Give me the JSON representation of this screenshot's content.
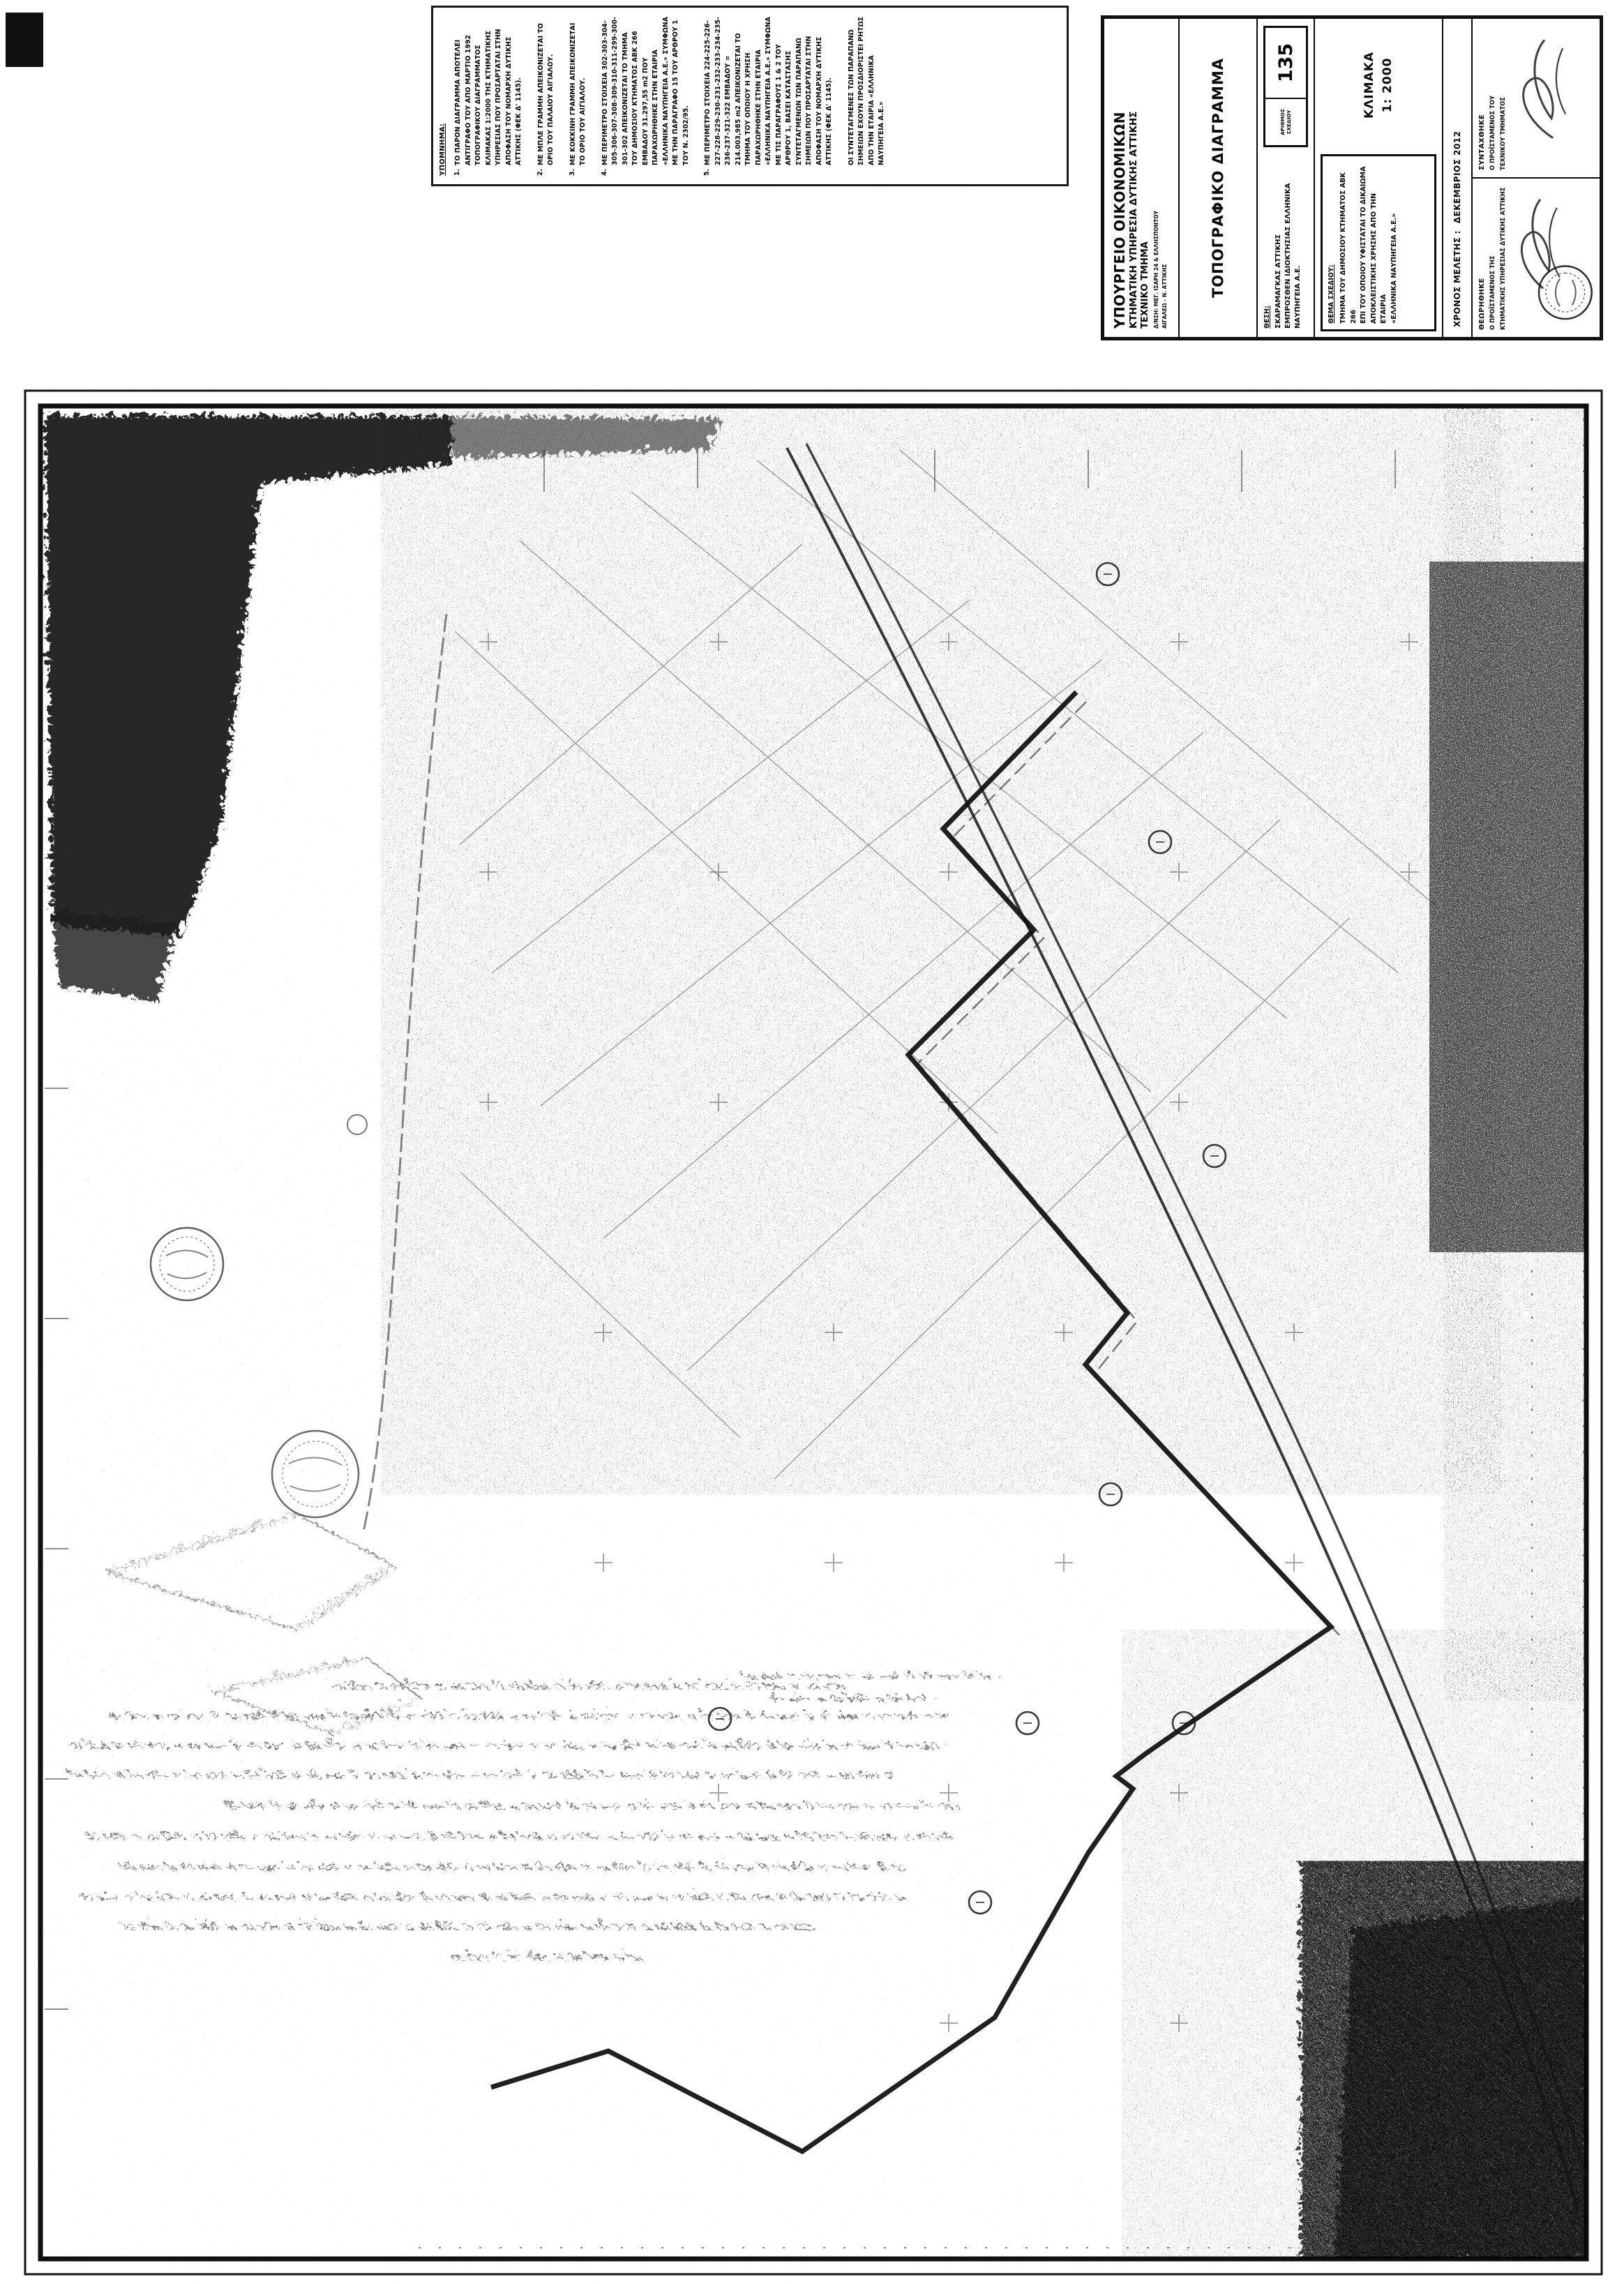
{
  "title_block": {
    "ministry": "ΥΠΟΥΡΓΕΙΟ ΟΙΚΟΝΟΜΙΚΩΝ",
    "service": "ΚΤΗΜΑΤΙΚΗ ΥΠΗΡΕΣΙΑ ΔΥΤΙΚΗΣ ΑΤΤΙΚΗΣ",
    "department": "ΤΕΧΝΙΚΟ ΤΜΗΜΑ",
    "address_line1": "Δ/ΝΣΗ: ΜΕΓ. ΙΣΑΡΗ 24 & ΕΛΛΗΣΠΟΝΤΟΥ",
    "address_line2": "ΑΙΓΑΛΕΩ - Ν. ΑΤΤΙΚΗΣ",
    "drawing_type": "ΤΟΠΟΓΡΑΦΙΚΟ ΔΙΑΓΡΑΜΜΑ",
    "location_label": "ΘΕΣΗ:",
    "location_line1": "ΣΚΑΡΑΜΑΓΚΑΣ ΑΤΤΙΚΗΣ",
    "location_line2": "ΕΜΠΡΟΣΘΕΝ ΙΔΙΟΚΤΗΣΙΑΣ ΕΛΛΗΝΙΚΑ ΝΑΥΠΗΓΕΙΑ Α.Ε.",
    "sheet_number_label": "ΑΡΙΘΜΟΣ ΣΧΕΔΙΟΥ",
    "sheet_number": "135",
    "scale_label": "ΚΛΙΜΑΚΑ",
    "scale_value": "1: 2000",
    "subject_label": "ΘΕΜΑ ΣΧΕΔΙΟΥ:",
    "subject_lines": {
      "0": "ΤΜΗΜΑ ΤΟΥ ΔΗΜΟΣΙΟΥ ΚΤΗΜΑΤΟΣ ΑΒΚ 266",
      "1": "ΕΠΙ ΤΟΥ ΟΠΟΙΟΥ ΥΦΙΣΤΑΤΑΙ ΤΟ ΔΙΚΑΙΩΜΑ",
      "2": "ΑΠΟΚΛΕΙΣΤΙΚΗΣ ΧΡΗΣΗΣ ΑΠΟ ΤΗΝ ΕΤΑΙΡΙΑ",
      "3": "«ΕΛΛΗΝΙΚΑ ΝΑΥΠΗΓΕΙΑ Α.Ε.»"
    },
    "date_label": "ΧΡΟΝΟΣ ΜΕΛΕΤΗΣ :",
    "date_value": "ΔΕΚΕΜΒΡΙΟΣ 2012",
    "reviewed_label": "ΘΕΩΡΗΘΗΚΕ",
    "reviewed_title_line1": "Ο ΠΡΟΪΣΤΑΜΕΝΟΣ ΤΗΣ",
    "reviewed_title_line2": "ΚΤΗΜΑΤΙΚΗΣ ΥΠΗΡΕΣΙΑΣ ΔΥΤΙΚΗΣ ΑΤΤΙΚΗΣ",
    "drafted_label": "ΣΥΝΤΑΧΘΗΚΕ",
    "drafted_title_line1": "Ο ΠΡΟΪΣΤΑΜΕΝΟΣ ΤΟΥ",
    "drafted_title_line2": "ΤΕΧΝΙΚΟΥ ΤΜΗΜΑΤΟΣ"
  },
  "notes_block": {
    "heading": "ΥΠΟΜΝΗΜΑ:",
    "notes": {
      "0": {
        "num": "1.",
        "text": "ΤΟ ΠΑΡΟΝ ΔΙΑΓΡΑΜΜΑ ΑΠΟΤΕΛΕΙ ΑΝΤΙΓΡΑΦΟ ΤΟΥ ΑΠΟ ΜΑΡΤΙΟ 1992 ΤΟΠΟΓΡΑΦΙΚΟΥ ΔΙΑΓΡΑΜΜΑΤΟΣ ΚΛΙΜΑΚΑΣ 1:2000 ΤΗΣ ΚΤΗΜΑΤΙΚΗΣ ΥΠΗΡΕΣΙΑΣ ΠΟΥ ΠΡΟΣΑΡΤΑΤΑΙ ΣΤΗΝ ΑΠΟΦΑΣΗ ΤΟΥ ΝΟΜΑΡΧΗ ΔΥΤΙΚΗΣ ΑΤΤΙΚΗΣ (ΦΕΚ Δ' 1145)."
      },
      "1": {
        "num": "2.",
        "text": "ΜΕ ΜΠΛΕ ΓΡΑΜΜΗ ΑΠΕΙΚΟΝΙΖΕΤΑΙ ΤΟ ΟΡΙΟ ΤΟΥ ΠΑΛΑΙΟΥ ΑΙΓΙΑΛΟΥ."
      },
      "2": {
        "num": "3.",
        "text": "ΜΕ ΚΟΚΚΙΝΗ ΓΡΑΜΜΗ ΑΠΕΙΚΟΝΙΖΕΤΑΙ ΤΟ ΟΡΙΟ ΤΟΥ ΑΙΓΙΑΛΟΥ."
      },
      "3": {
        "num": "4.",
        "text": "ΜΕ ΠΕΡΙΜΕΤΡΟ ΣΤΟΙΧΕΙΑ 302-303-304-305-306-307-308-309-310-311-299-300-301-302 ΑΠΕΙΚΟΝΙΖΕΤΑΙ ΤΟ ΤΜΗΜΑ ΤΟΥ ΔΗΜΟΣΙΟΥ ΚΤΗΜΑΤΟΣ ΑΒΚ 266 ΕΜΒΑΔΟΥ 31.297,55 m2 ΠΟΥ ΠΑΡΑΧΩΡΗΘΗΚΕ ΣΤΗΝ ΕΤΑΙΡΙΑ «ΕΛΛΗΝΙΚΑ ΝΑΥΠΗΓΕΙΑ Α.Ε.» ΣΥΜΦΩΝΑ ΜΕ ΤΗΝ ΠΑΡΑΓΡΑΦΟ 15 ΤΟΥ ΑΡΘΡΟΥ 1 ΤΟΥ Ν. 2302/95."
      },
      "4": {
        "num": "5.",
        "text": "ΜΕ ΠΕΡΙΜΕΤΡΟ ΣΤΟΙΧΕΙΑ 224-225-226-227-228-229-230-231-232-233-234-235-236-237-321-322 ΕΜΒΑΔΟΥ = 214.003,985 m2 ΑΠΕΙΚΟΝΙΖΕΤΑΙ ΤΟ ΤΜΗΜΑ ΤΟΥ ΟΠΟΙΟΥ Η ΧΡΗΣΗ ΠΑΡΑΧΩΡΗΘΗΚΕ ΣΤΗΝ ΕΤΑΙΡΙΑ «ΕΛΛΗΝΙΚΑ ΝΑΥΠΗΓΕΙΑ Α.Ε.» ΣΥΜΦΩΝΑ ΜΕ ΤΙΣ ΠΑΡΑΓΡΑΦΟΥΣ 1 & 2 ΤΟΥ ΑΡΘΡΟΥ 1, ΒΑΣΕΙ ΚΑΤΑΣΤΑΣΗΣ ΣΥΝΤΕΤΑΓΜΕΝΩΝ ΤΩΝ ΠΑΡΑΠΑΝΩ ΣΗΜΕΙΩΝ ΠΟΥ ΠΡΟΣΑΡΤΑΤΑΙ ΣΤΗΝ ΑΠΟΦΑΣΗ ΤΟΥ ΝΟΜΑΡΧΗ ΔΥΤΙΚΗΣ ΑΤΤΙΚΗΣ (ΦΕΚ Δ' 1145)."
      },
      "5": {
        "num": "",
        "text": "ΟΙ ΣΥΝΤΕΤΑΓΜΕΝΕΣ ΤΩΝ ΠΑΡΑΠΑΝΩ ΣΗΜΕΙΩΝ ΕΧΟΥΝ ΠΡΟΣΔΙΟΡΙΣΤΕΙ ΡΗΤΩΣ ΑΠΟ ΤΗΝ ΕΤΑΙΡΙΑ «ΕΛΛΗΝΙΚΑ ΝΑΥΠΗΓΕΙΑ Α.Ε.»"
      }
    }
  }
}
